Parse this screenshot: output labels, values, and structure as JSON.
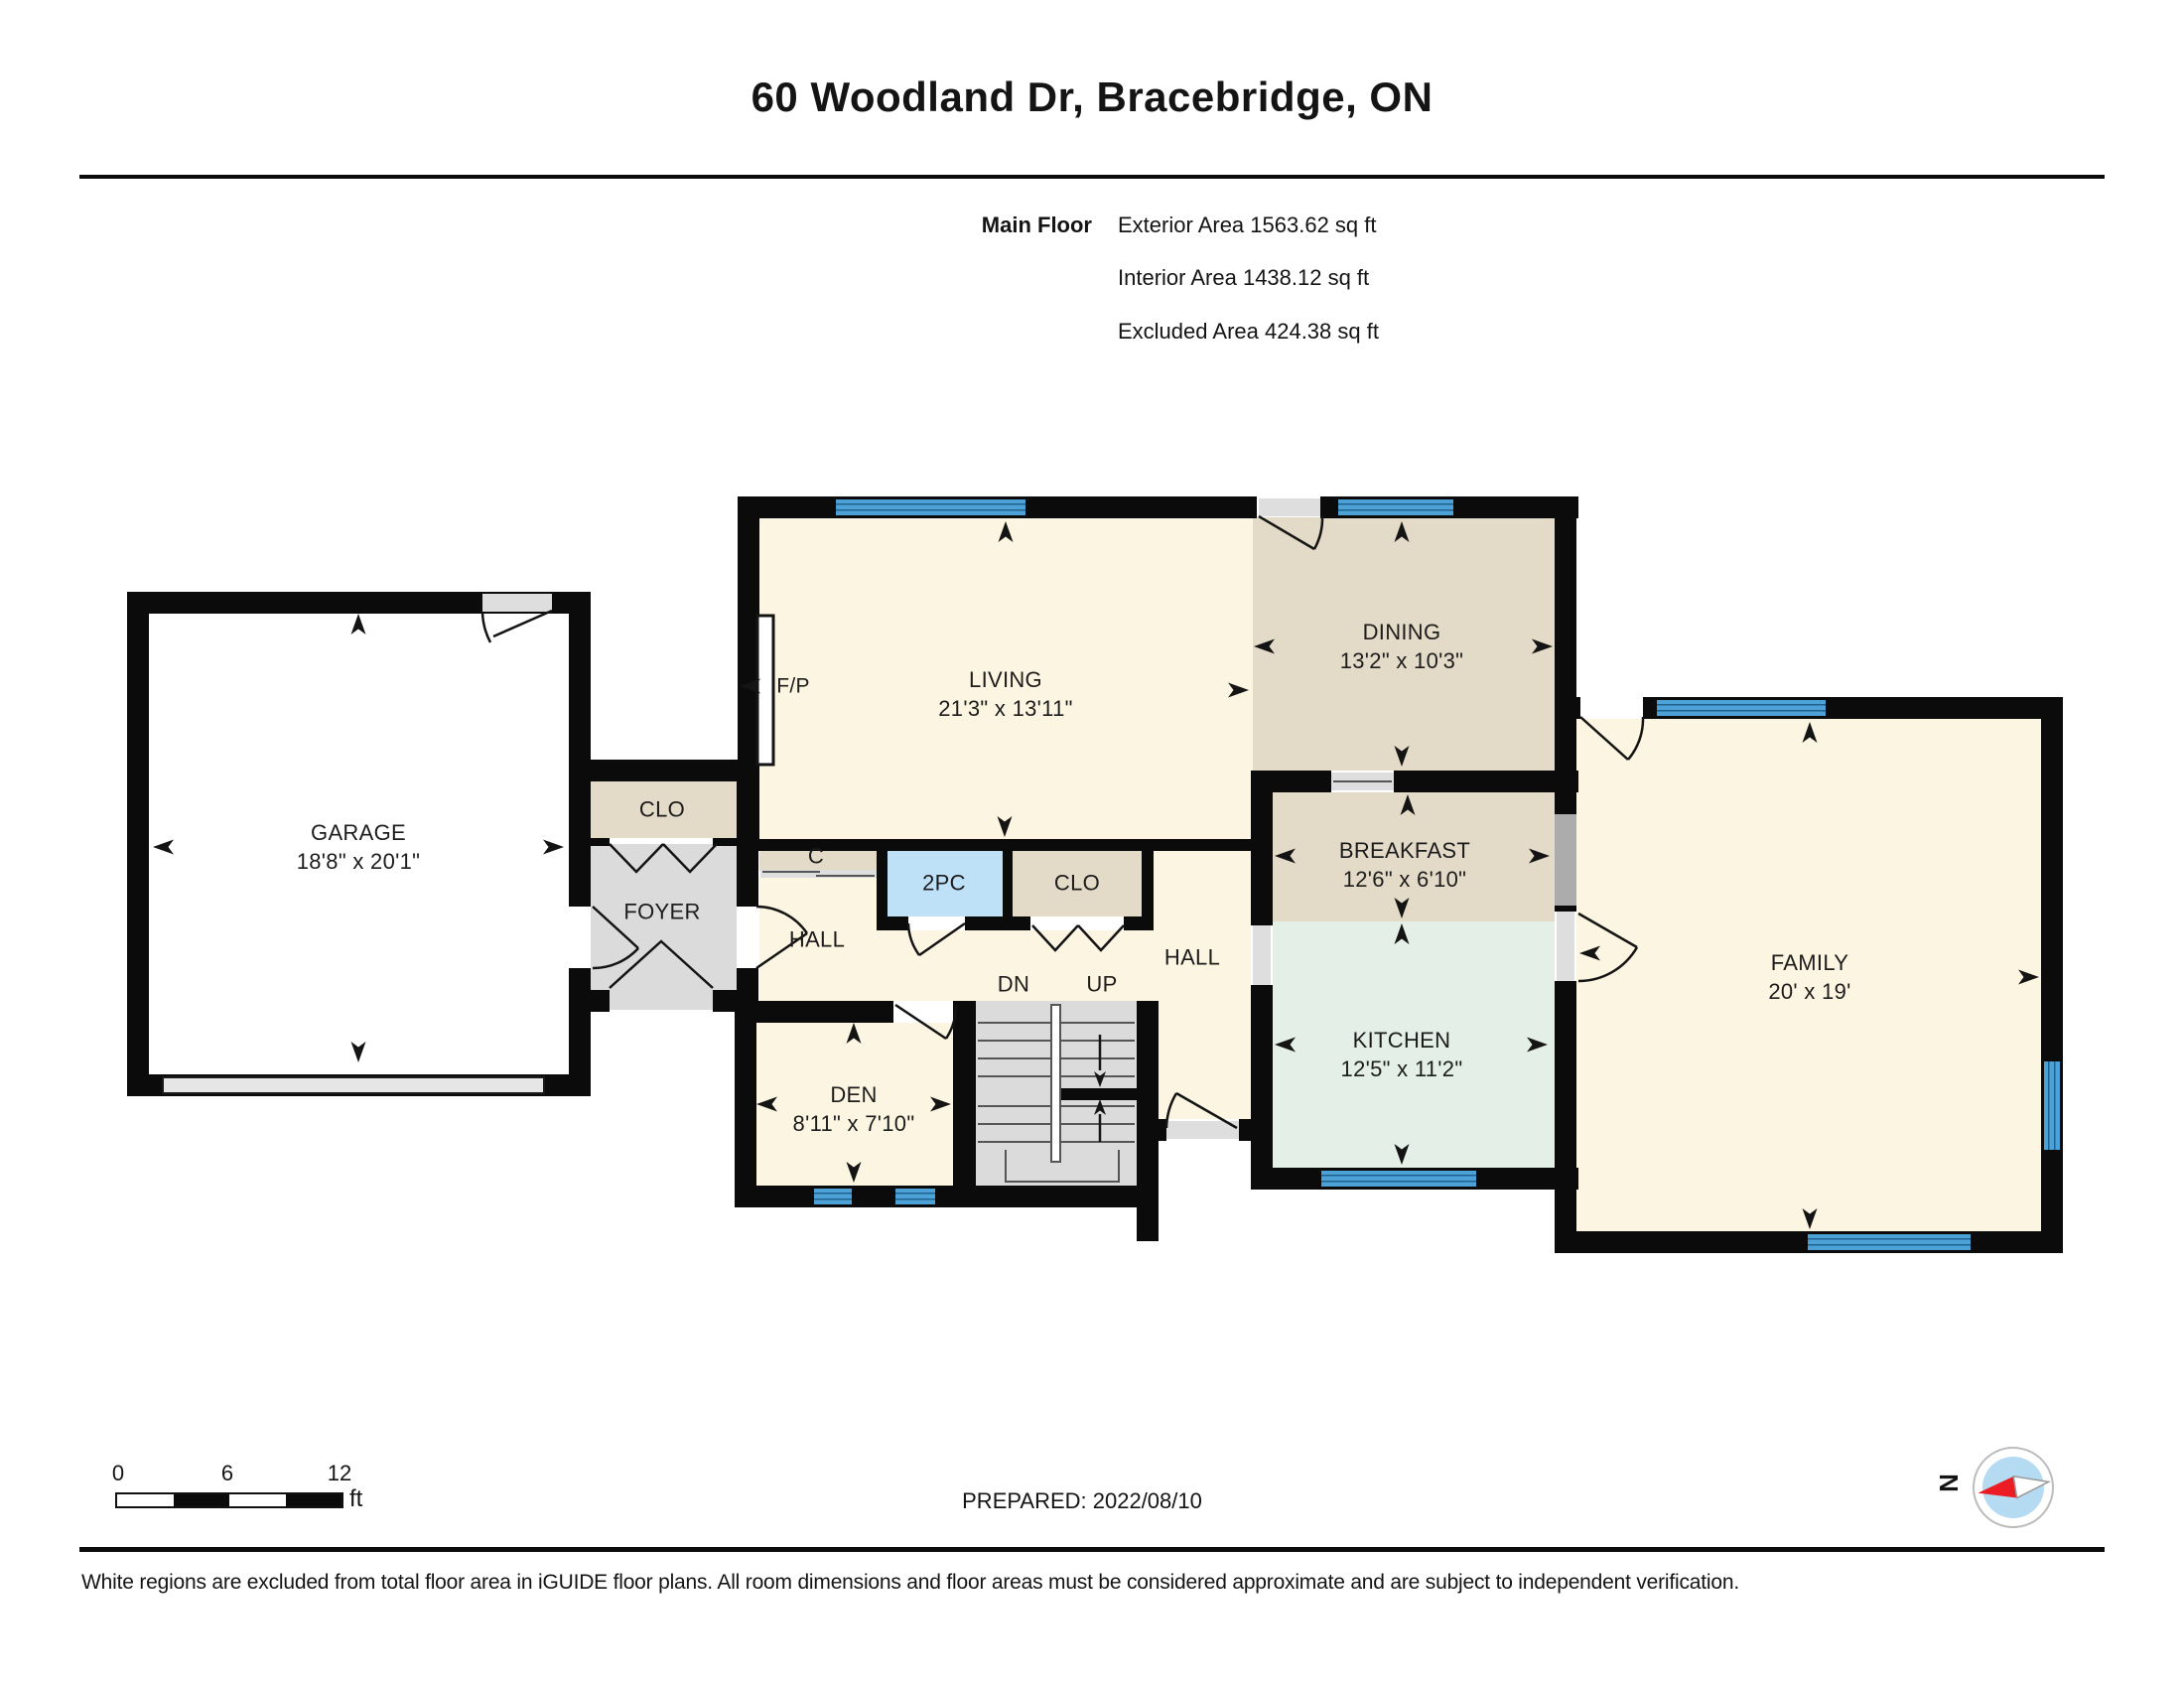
{
  "header": {
    "title": "60 Woodland Dr, Bracebridge, ON",
    "floor_label": "Main Floor",
    "areas": [
      "Exterior Area 1563.62 sq ft",
      "Interior Area 1438.12 sq ft",
      "Excluded Area 424.38 sq ft"
    ]
  },
  "rooms": {
    "garage": {
      "name": "GARAGE",
      "dims": "18'8\" x 20'1\""
    },
    "living": {
      "name": "LIVING",
      "dims": "21'3\" x 13'11\""
    },
    "dining": {
      "name": "DINING",
      "dims": "13'2\" x 10'3\""
    },
    "breakfast": {
      "name": "BREAKFAST",
      "dims": "12'6\" x 6'10\""
    },
    "family": {
      "name": "FAMILY",
      "dims": "20' x 19'"
    },
    "kitchen": {
      "name": "KITCHEN",
      "dims": "12'5\" x 11'2\""
    },
    "den": {
      "name": "DEN",
      "dims": "8'11\" x 7'10\""
    },
    "foyer": {
      "name": "FOYER"
    },
    "closet_entry": {
      "name": "CLO"
    },
    "closet_hall": {
      "name": "CLO"
    },
    "closet_c": {
      "name": "C"
    },
    "hall_left": {
      "name": "HALL"
    },
    "hall_right": {
      "name": "HALL"
    },
    "powder": {
      "name": "2PC"
    },
    "fireplace": {
      "name": "F/P"
    },
    "stairs": {
      "down_label": "DN",
      "up_label": "UP"
    }
  },
  "footer": {
    "scale": {
      "start": "0",
      "mid": "6",
      "end": "12",
      "unit": "ft"
    },
    "prepared": "PREPARED: 2022/08/10",
    "compass_north": "N",
    "disclaimer": "White regions are excluded from total floor area in iGUIDE floor plans. All room dimensions and floor areas must be considered approximate and are subject to independent verification."
  },
  "colors": {
    "floor_cream": "#FCF5E1",
    "floor_tan": "#E3DAC8",
    "floor_mint": "#E4EFE8",
    "floor_gray": "#DBDBDB",
    "powder_blue": "#BFE1F8",
    "window_blue": "#4CA2D6",
    "wall_black": "#0b0b0b",
    "compass_red": "#EC1C24",
    "compass_blue": "#B5DBF3"
  }
}
